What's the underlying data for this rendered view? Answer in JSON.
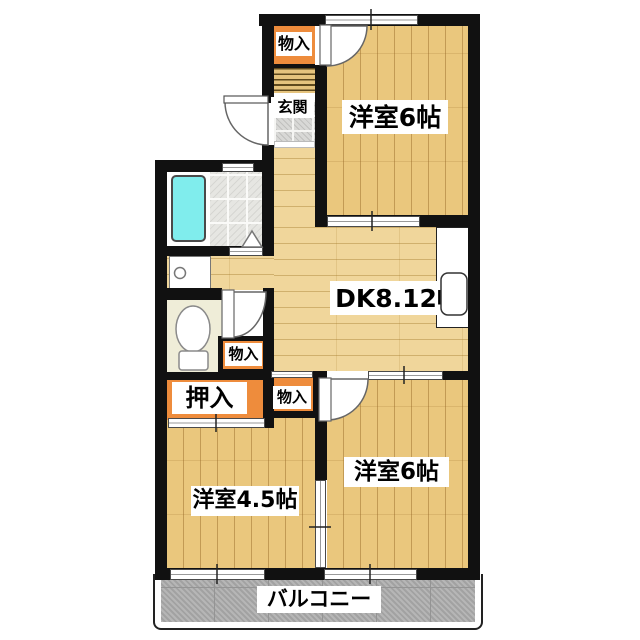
{
  "plan": {
    "type": "apartment-floorplan",
    "rooms": {
      "bedroom_top": {
        "label": "洋室6帖"
      },
      "dk": {
        "label": "DK8.12帖"
      },
      "bedroom_right": {
        "label": "洋室6帖"
      },
      "bedroom_left": {
        "label": "洋室4.5帖"
      },
      "balcony": {
        "label": "バルコニー"
      },
      "genkan": {
        "label": "玄関"
      },
      "oshiire": {
        "label": "押入"
      },
      "storage_top": {
        "label": "物入"
      },
      "storage_mid": {
        "label": "物入"
      },
      "storage_bottom": {
        "label": "物入"
      }
    },
    "fixtures": [
      "bathtub",
      "washroom",
      "toilet",
      "kitchen-sink",
      "entrance-door",
      "folding-door",
      "water-heater-niche"
    ],
    "colors": {
      "wall": "#111111",
      "room_floor": "#eac77d",
      "dk_floor": "#f0d69b",
      "closet_orange": "#ee8c3c",
      "bathtub_cyan": "#80eded",
      "balcony_gray": "#aeaeae",
      "genkan_tile": "#d8d8d6",
      "toilet_floor": "#efedd8"
    }
  }
}
